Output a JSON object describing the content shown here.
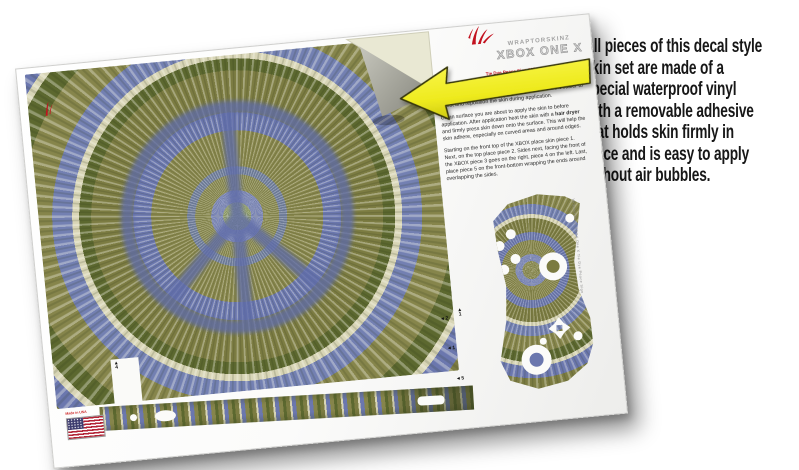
{
  "annotation": {
    "lines": [
      "All pieces of this decal style",
      "skin set are made of a",
      "special waterproof vinyl",
      "with a removable adhesive",
      "that holds skin firmly in",
      "place and is easy to apply",
      "without air bubbles."
    ]
  },
  "sheet": {
    "brand": "WRAPTORSKINZ",
    "title": "XBOX ONE X",
    "subtitle": "Tie Dye Peace Sign 102",
    "instructions": {
      "p1": "The removable adhesive has light tackiness at first but gets stronger over a few days after applied. This makes it easier to adjust and reposition the skin during application.",
      "p2_pre": "Clean surface you are about to apply the skin to before application. After application heat the skin with a ",
      "p2_bold": "hair dryer",
      "p2_post": " and firmly press skin down onto the surface. This will help the skin adhere, especially on curved areas and around edges.",
      "p3": "Starting on the front top of the XBOX place skin piece 1. Next, on the top place piece 2. Sides next, facing the front of the XBOX piece 3 goes on the right, piece 4 on the left. Last, place piece 5 on the front-bottom wrapping the ends around overlapping the sides."
    },
    "piece_labels": [
      {
        "arrow": "◄",
        "num": "2"
      },
      {
        "arrow": "▲",
        "num": "1"
      },
      {
        "arrow": "◄",
        "num": "1"
      },
      {
        "arrow": "◄",
        "num": "5"
      },
      {
        "arrow": "▲",
        "num": "4"
      }
    ],
    "made_in_label": "Made in USA",
    "fine_print": "WraptorSkinz XBOX One X Tie Dye Peace Sign"
  },
  "colors": {
    "arrow_yellow": "#f0ee23",
    "brand_red": "#c3121f",
    "tiedye_olive": "#7c7c42",
    "tiedye_dark_green": "#5c682f",
    "tiedye_blue": "#6b77ae",
    "tiedye_cream": "#d8d5b6"
  }
}
